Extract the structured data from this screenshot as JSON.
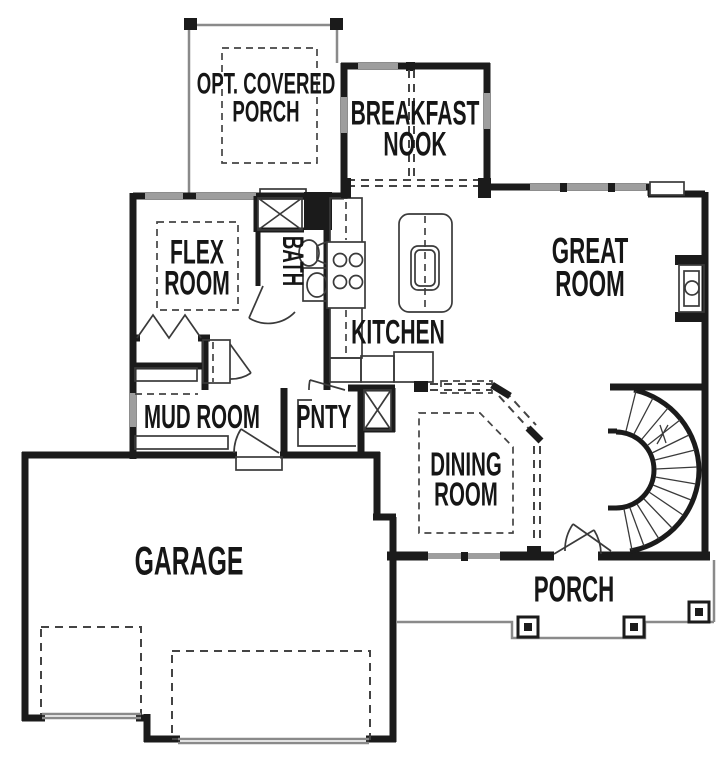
{
  "plan_type": "floor-plan",
  "colors": {
    "wall": "#1b1b1b",
    "window": "#9e9e9e",
    "line": "#3a3a3a",
    "dash": "#444444",
    "porchline": "#8a8a8a",
    "bg": "#ffffff",
    "text": "#161616"
  },
  "rooms": {
    "opt_covered_porch": {
      "label": "OPT. COVERED\nPORCH"
    },
    "breakfast_nook": {
      "label": "BREAKFAST\nNOOK"
    },
    "flex_room": {
      "label": "FLEX\nROOM"
    },
    "bath": {
      "label": "BATH"
    },
    "kitchen": {
      "label": "KITCHEN"
    },
    "great_room": {
      "label": "GREAT\nROOM"
    },
    "mud_room": {
      "label": "MUD ROOM"
    },
    "pantry": {
      "label": "PNTY"
    },
    "dining_room": {
      "label": "DINING\nROOM"
    },
    "garage": {
      "label": "GARAGE"
    },
    "porch": {
      "label": "PORCH"
    }
  }
}
